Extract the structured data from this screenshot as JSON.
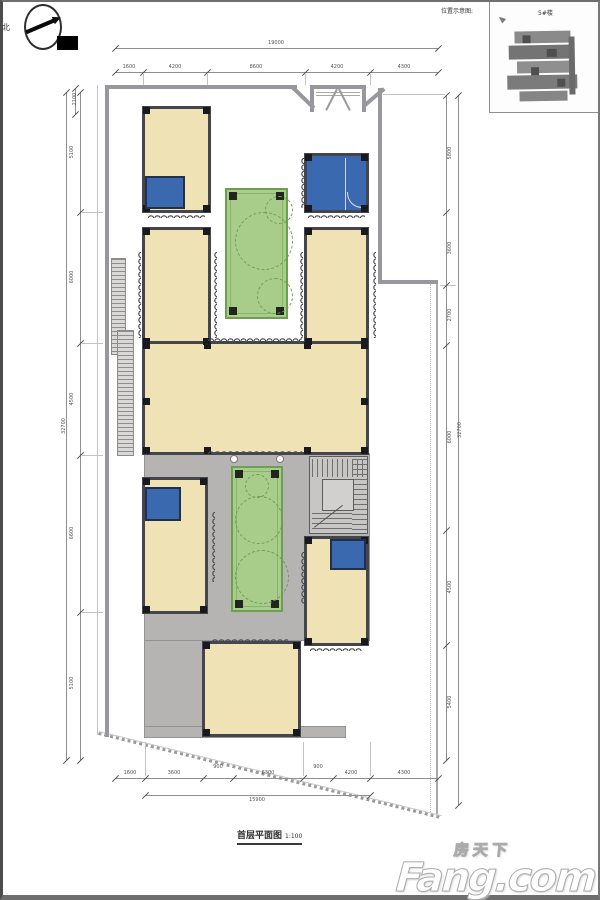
{
  "palette": {
    "wall_dark": "#45454d",
    "room_fill": "#efe3b6",
    "blue": "#3a69b0",
    "blue_border": "#22304e",
    "green_fill": "#a8cd8b",
    "green_border": "#6d9f53",
    "plaza": "#b5b4b2",
    "boundary": "#97979d",
    "dim": "#8f8f8f"
  },
  "compass": {
    "north_label": "北"
  },
  "inset": {
    "caption": "位置示意图:",
    "building_label": "5#楼"
  },
  "caption": {
    "title": "首层平面图",
    "scale": "1:100"
  },
  "watermark": {
    "cn": "房天下",
    "en": "Fang.com"
  },
  "dimensions": {
    "top": {
      "overall": "19000",
      "segments": [
        "1600",
        "4200",
        "8600",
        "4200",
        "4300"
      ]
    },
    "bottom": {
      "overall": "15900",
      "segments": [
        "1600",
        "3600",
        "900",
        "6300",
        "900",
        "4200",
        "4300"
      ]
    },
    "left": {
      "overall": "32700",
      "mini": "2100",
      "segments": [
        "5100",
        "6000",
        "4500",
        "6600",
        "5100"
      ]
    },
    "right": {
      "overall": "32700",
      "segments": [
        "5800",
        "3600",
        "2700",
        "6000",
        "4500",
        "5400"
      ]
    }
  }
}
